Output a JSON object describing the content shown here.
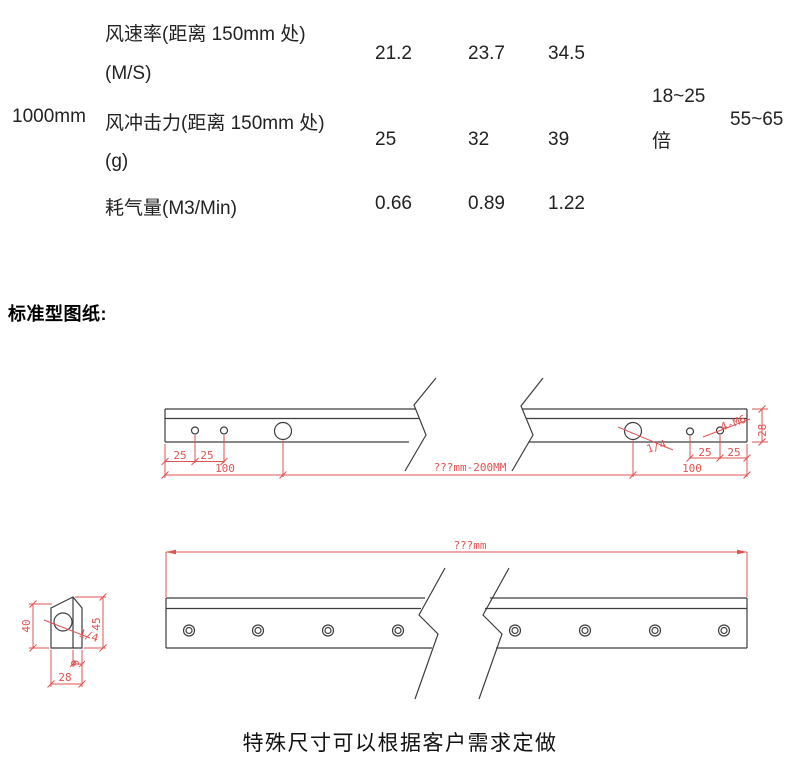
{
  "spec_table": {
    "row_header": "1000mm",
    "rows": [
      {
        "label": "风速率(距离 150mm 处)",
        "label2": "(M/S)",
        "values": [
          "21.2",
          "23.7",
          "34.5"
        ]
      },
      {
        "label": "风冲击力(距离 150mm 处)",
        "label2": "(g)",
        "values": [
          "25",
          "32",
          "39"
        ]
      },
      {
        "label": "耗气量(M3/Min)",
        "values": [
          "0.66",
          "0.89",
          "1.22"
        ]
      }
    ],
    "amplification_line1": "18~25",
    "amplification_line2": "倍",
    "amplification2": "55~65"
  },
  "section_title": "标准型图纸:",
  "drawing_top": {
    "dim_25_1": "25",
    "dim_25_2": "25",
    "dim_100_left": "100",
    "dim_length": "???mm-200MM",
    "label_quarter": "1/4",
    "label_thread": "4-M6",
    "dim_25_3": "25",
    "dim_25_4": "25",
    "dim_100_right": "100",
    "dim_height": "28"
  },
  "drawing_bottom": {
    "dim_length": "???mm",
    "profile_height": "40",
    "profile_total_height": "45",
    "profile_tip_width": "9",
    "profile_width": "28",
    "label_quarter": "1/4"
  },
  "footer_note": "特殊尺寸可以根据客户需求定做",
  "colors": {
    "dimension_red": "#e05353",
    "outline_black": "#3d3d3d"
  }
}
